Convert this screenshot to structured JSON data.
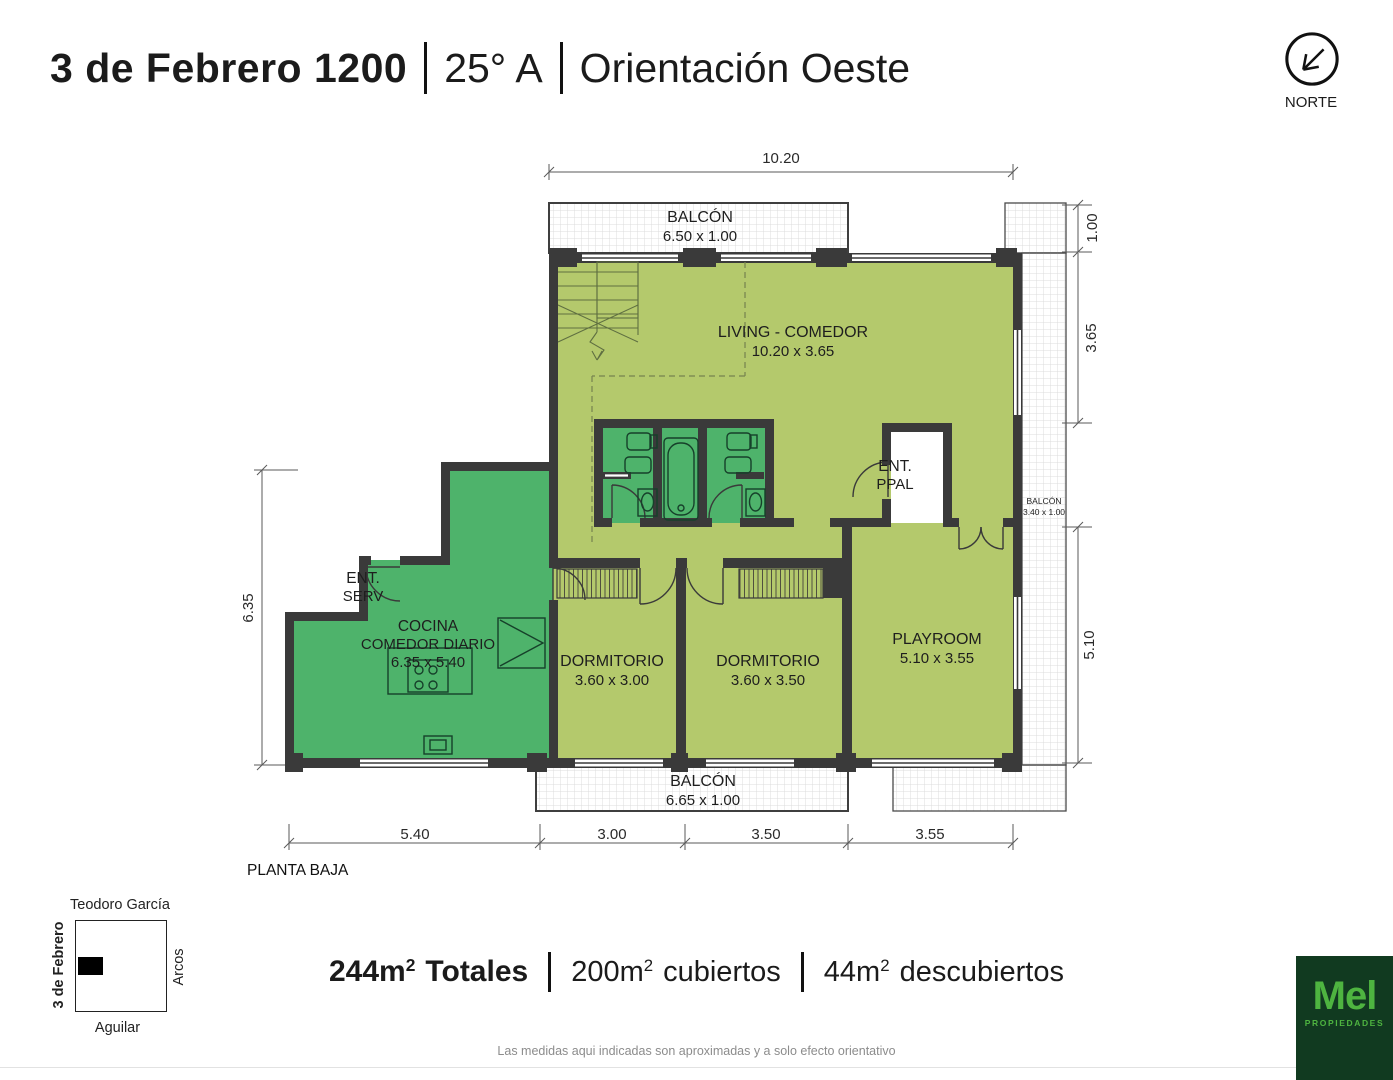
{
  "header": {
    "address": "3 de Febrero 1200",
    "unit": "25° A",
    "orientation": "Orientación Oeste"
  },
  "compass": {
    "label": "NORTE"
  },
  "plan": {
    "floor_label": "PLANTA BAJA",
    "rooms": {
      "balcon_top": {
        "name": "BALCÓN",
        "dims": "6.50 x 1.00"
      },
      "living": {
        "name": "LIVING - COMEDOR",
        "dims": "10.20 x 3.65"
      },
      "ent_ppal": {
        "line1": "ENT.",
        "line2": "PPAL"
      },
      "balcon_right": {
        "name": "BALCÓN",
        "dims": "3.40 x 1.00"
      },
      "ent_serv": {
        "line1": "ENT.",
        "line2": "SERV"
      },
      "cocina": {
        "name_line1": "COCINA",
        "name_line2": "COMEDOR DIARIO",
        "dims": "6.35 x 5.40"
      },
      "dormitorio1": {
        "name": "DORMITORIO",
        "dims": "3.60 x 3.00"
      },
      "dormitorio2": {
        "name": "DORMITORIO",
        "dims": "3.60 x 3.50"
      },
      "playroom": {
        "name": "PLAYROOM",
        "dims": "5.10 x 3.55"
      },
      "balcon_bottom": {
        "name": "BALCÓN",
        "dims": "6.65 x 1.00"
      }
    },
    "dimensions": {
      "top": "10.20",
      "right_top": "1.00",
      "right_mid": "3.65",
      "right_bottom": "5.10",
      "left": "6.35",
      "bottom": [
        "5.40",
        "3.00",
        "3.50",
        "3.55"
      ]
    }
  },
  "map": {
    "north_street": "Teodoro García",
    "west_street": "3 de Febrero",
    "east_street": "Arcos",
    "south_street": "Aguilar"
  },
  "summary": {
    "total": {
      "value": "244m",
      "sup": "2",
      "label": "Totales"
    },
    "covered": {
      "value": "200m",
      "sup": "2",
      "label": "cubiertos"
    },
    "uncovered": {
      "value": "44m",
      "sup": "2",
      "label": "descubiertos"
    }
  },
  "disclaimer": "Las medidas aqui indicadas son aproximadas y a solo efecto orientativo",
  "logo": {
    "brand": "Mel",
    "subtitle": "PROPIEDADES"
  },
  "colors": {
    "light_green": "#b4c96c",
    "dark_green": "#4eb36b",
    "wall": "#3a3a3a",
    "logo_bg": "#113a20",
    "logo_green": "#4eb440"
  }
}
